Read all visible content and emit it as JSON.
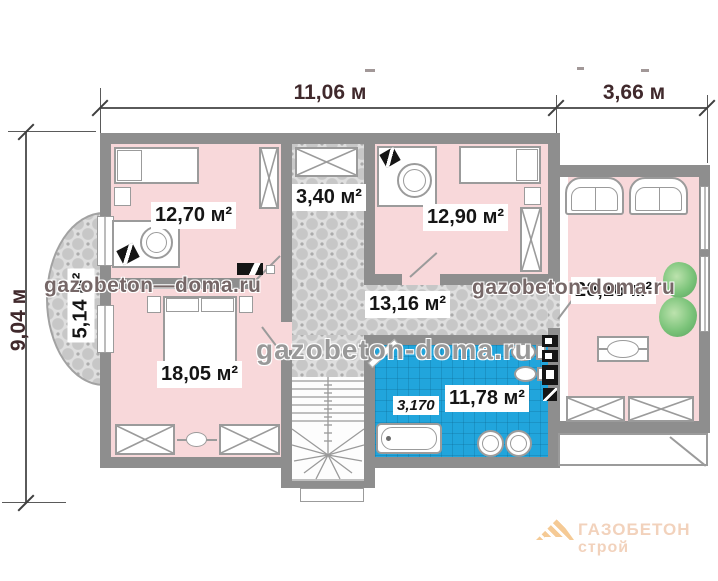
{
  "dimensions": {
    "top_main": "11,06 м",
    "top_wing": "3,66 м",
    "left": "9,04 м"
  },
  "rooms": [
    {
      "name": "bedroom-top-left",
      "label": "12,70 м²"
    },
    {
      "name": "closet",
      "label": "3,40 м²"
    },
    {
      "name": "bedroom-top-right",
      "label": "12,90 м²"
    },
    {
      "name": "living-room-right",
      "label": "20,16 м²"
    },
    {
      "name": "balcony",
      "label": "5,14 м²"
    },
    {
      "name": "hallway",
      "label": "13,16 м²"
    },
    {
      "name": "bedroom-bottom-left",
      "label": "18,05 м²"
    },
    {
      "name": "bathroom",
      "label": "11,78 м²"
    }
  ],
  "annotations": {
    "bathtub_length": "3,170"
  },
  "watermarks": {
    "left": "gazobeton—doma.ru",
    "center": "gazobeton-doma.ru",
    "right": "gazobeton-doma.ru",
    "logo_line1": "ГАЗОБЕТОН",
    "logo_line2": "строй"
  },
  "colors": {
    "wall_gray": "#8e8e8e",
    "room_pink": "#f8d8da",
    "tile_gray": "#dedede",
    "bathroom_blue": "#21a5dc",
    "plant_green": "#74c274",
    "logo_orange": "#eda03f",
    "dimension_text": "#40292c"
  }
}
